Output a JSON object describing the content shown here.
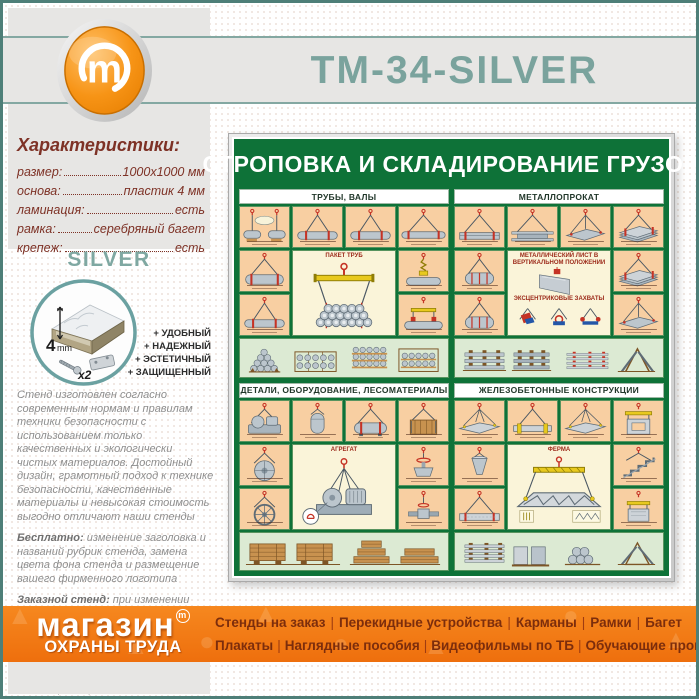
{
  "header": {
    "title": "ТМ-34-SILVER"
  },
  "colors": {
    "frame_teal": "#4e7f78",
    "title_sage": "#7aa39d",
    "maroon_text": "#7e3226",
    "poster_green": "#0e7238",
    "cell_peach": "#f8cfa2",
    "center_cream": "#faf4d9",
    "band_light_green": "#dcead3",
    "footer_orange": "#f07a16",
    "menu_maroon": "#7c2d0c",
    "logo_orange": "#f18c00"
  },
  "characteristics": {
    "heading": "Характеристики:",
    "rows": [
      {
        "label": "размер:",
        "value": "1000х1000  мм"
      },
      {
        "label": "основа:",
        "value": "пластик 4 мм"
      },
      {
        "label": "ламинация:",
        "value": "есть"
      },
      {
        "label": "рамка:",
        "value": "серебряный багет"
      },
      {
        "label": "крепеж:",
        "value": "есть"
      }
    ]
  },
  "series_label": "SILVER",
  "panel": {
    "thickness_number": "4",
    "thickness_unit": "mm",
    "quantity": "x2"
  },
  "features": [
    "+ УДОБНЫЙ",
    "+ НАДЕЖНЫЙ",
    "+ ЭСТЕТИЧНЫЙ",
    "+ ЗАЩИЩЕННЫЙ"
  ],
  "paragraphs": [
    [
      {
        "t": "Стенд изготовлен согласно современным нормам и правилам техники безопасности с использованием только качественных и экологически чистых материалов. Достойный дизайн, грамотный подход к технике безопасности, качественные материалы и невысокая стоимость выгодно отличают наши стенды",
        "b": false
      }
    ],
    [
      {
        "t": "Бесплатно:",
        "b": true
      },
      {
        "t": " изменение заголовка и названий рубрик стенда, замена цвета фона стенда и размещение вашего фирменного логотипа",
        "b": false
      }
    ],
    [
      {
        "t": "Заказной стенд:",
        "b": true
      },
      {
        "t": " при изменении содержимого стенда (карманов или плакатов) - он считается заказным и его стоимость рассчитывается отдельно",
        "b": false
      }
    ],
    [
      {
        "t": "Изготавливаем ",
        "b": false
      },
      {
        "t": "стенды на заказ",
        "b": true
      },
      {
        "t": " - любого размера, любой комплектации, любого дизайна и оформления",
        "b": false
      }
    ]
  ],
  "poster": {
    "title": "СТРОПОВКА И СКЛАДИРОВАНИЕ ГРУЗОВ",
    "quadrants": [
      {
        "title": "ТРУБЫ, ВАЛЫ",
        "row1": [
          "pipe-two-hooks",
          "pipe",
          "pipe",
          "pipe-long"
        ],
        "left": [
          "pipe-wide",
          "pipe"
        ],
        "center": {
          "label": "ПАКЕТ ТРУБ",
          "art": "pipe-bundle"
        },
        "right": [
          "chain-grab",
          "pipe-clamps"
        ],
        "bottom": [
          "stack-pipes",
          "stack-pipes-rack"
        ]
      },
      {
        "title": "МЕТАЛЛОПРОКАТ",
        "row1": [
          "channel",
          "ibeam",
          "sheet-flat",
          "sheet-pack"
        ],
        "left": [
          "coil",
          "coil"
        ],
        "center": {
          "label": "МЕТАЛЛИЧЕСКИЙ ЛИСТ В ВЕРТИКАЛЬНОМ ПОЛОЖЕНИИ",
          "art": "sheet-vertical",
          "sublabel": "ЭКСЦЕНТРИКОВЫЕ ЗАХВАТЫ",
          "art2": "clamps-row"
        },
        "right": [
          "sheet-pack",
          "sheet-flat"
        ],
        "bottom": [
          "stack-beams",
          "stack-sheets"
        ]
      },
      {
        "title": "ДЕТАЛИ, ОБОРУДОВАНИЕ, ЛЕСОМАТЕРИАЛЫ",
        "row1": [
          "motor",
          "vessel",
          "tank",
          "crate"
        ],
        "left": [
          "disc",
          "flywheel"
        ],
        "center": {
          "label": "АГРЕГАТ",
          "art": "agregat"
        },
        "right": [
          "valve",
          "valve2"
        ],
        "bottom": [
          "stack-timber",
          "stack-pallets"
        ]
      },
      {
        "title": "ЖЕЛЕЗОБЕТОННЫЕ КОНСТРУКЦИИ",
        "row1": [
          "slab",
          "slab-beam",
          "slab",
          "panel-traverse"
        ],
        "left": [
          "bucket",
          "beam-concrete"
        ],
        "center": {
          "label": "ФЕРМА",
          "art": "truss"
        },
        "right": [
          "stairs",
          "block-traverse"
        ],
        "bottom": [
          "stack-slabs",
          "stack-columns"
        ]
      }
    ]
  },
  "footer": {
    "logo": {
      "line1": "магазин",
      "mark": "m",
      "line2": "ОХРАНЫ ТРУДА"
    },
    "menu_row1": [
      "Стенды на заказ",
      "Перекидные устройства",
      "Карманы",
      "Рамки",
      "Багет"
    ],
    "menu_row2": [
      "Плакаты",
      "Наглядные пособия",
      "Видеофильмы по ТБ",
      "Обучающие программы"
    ]
  }
}
